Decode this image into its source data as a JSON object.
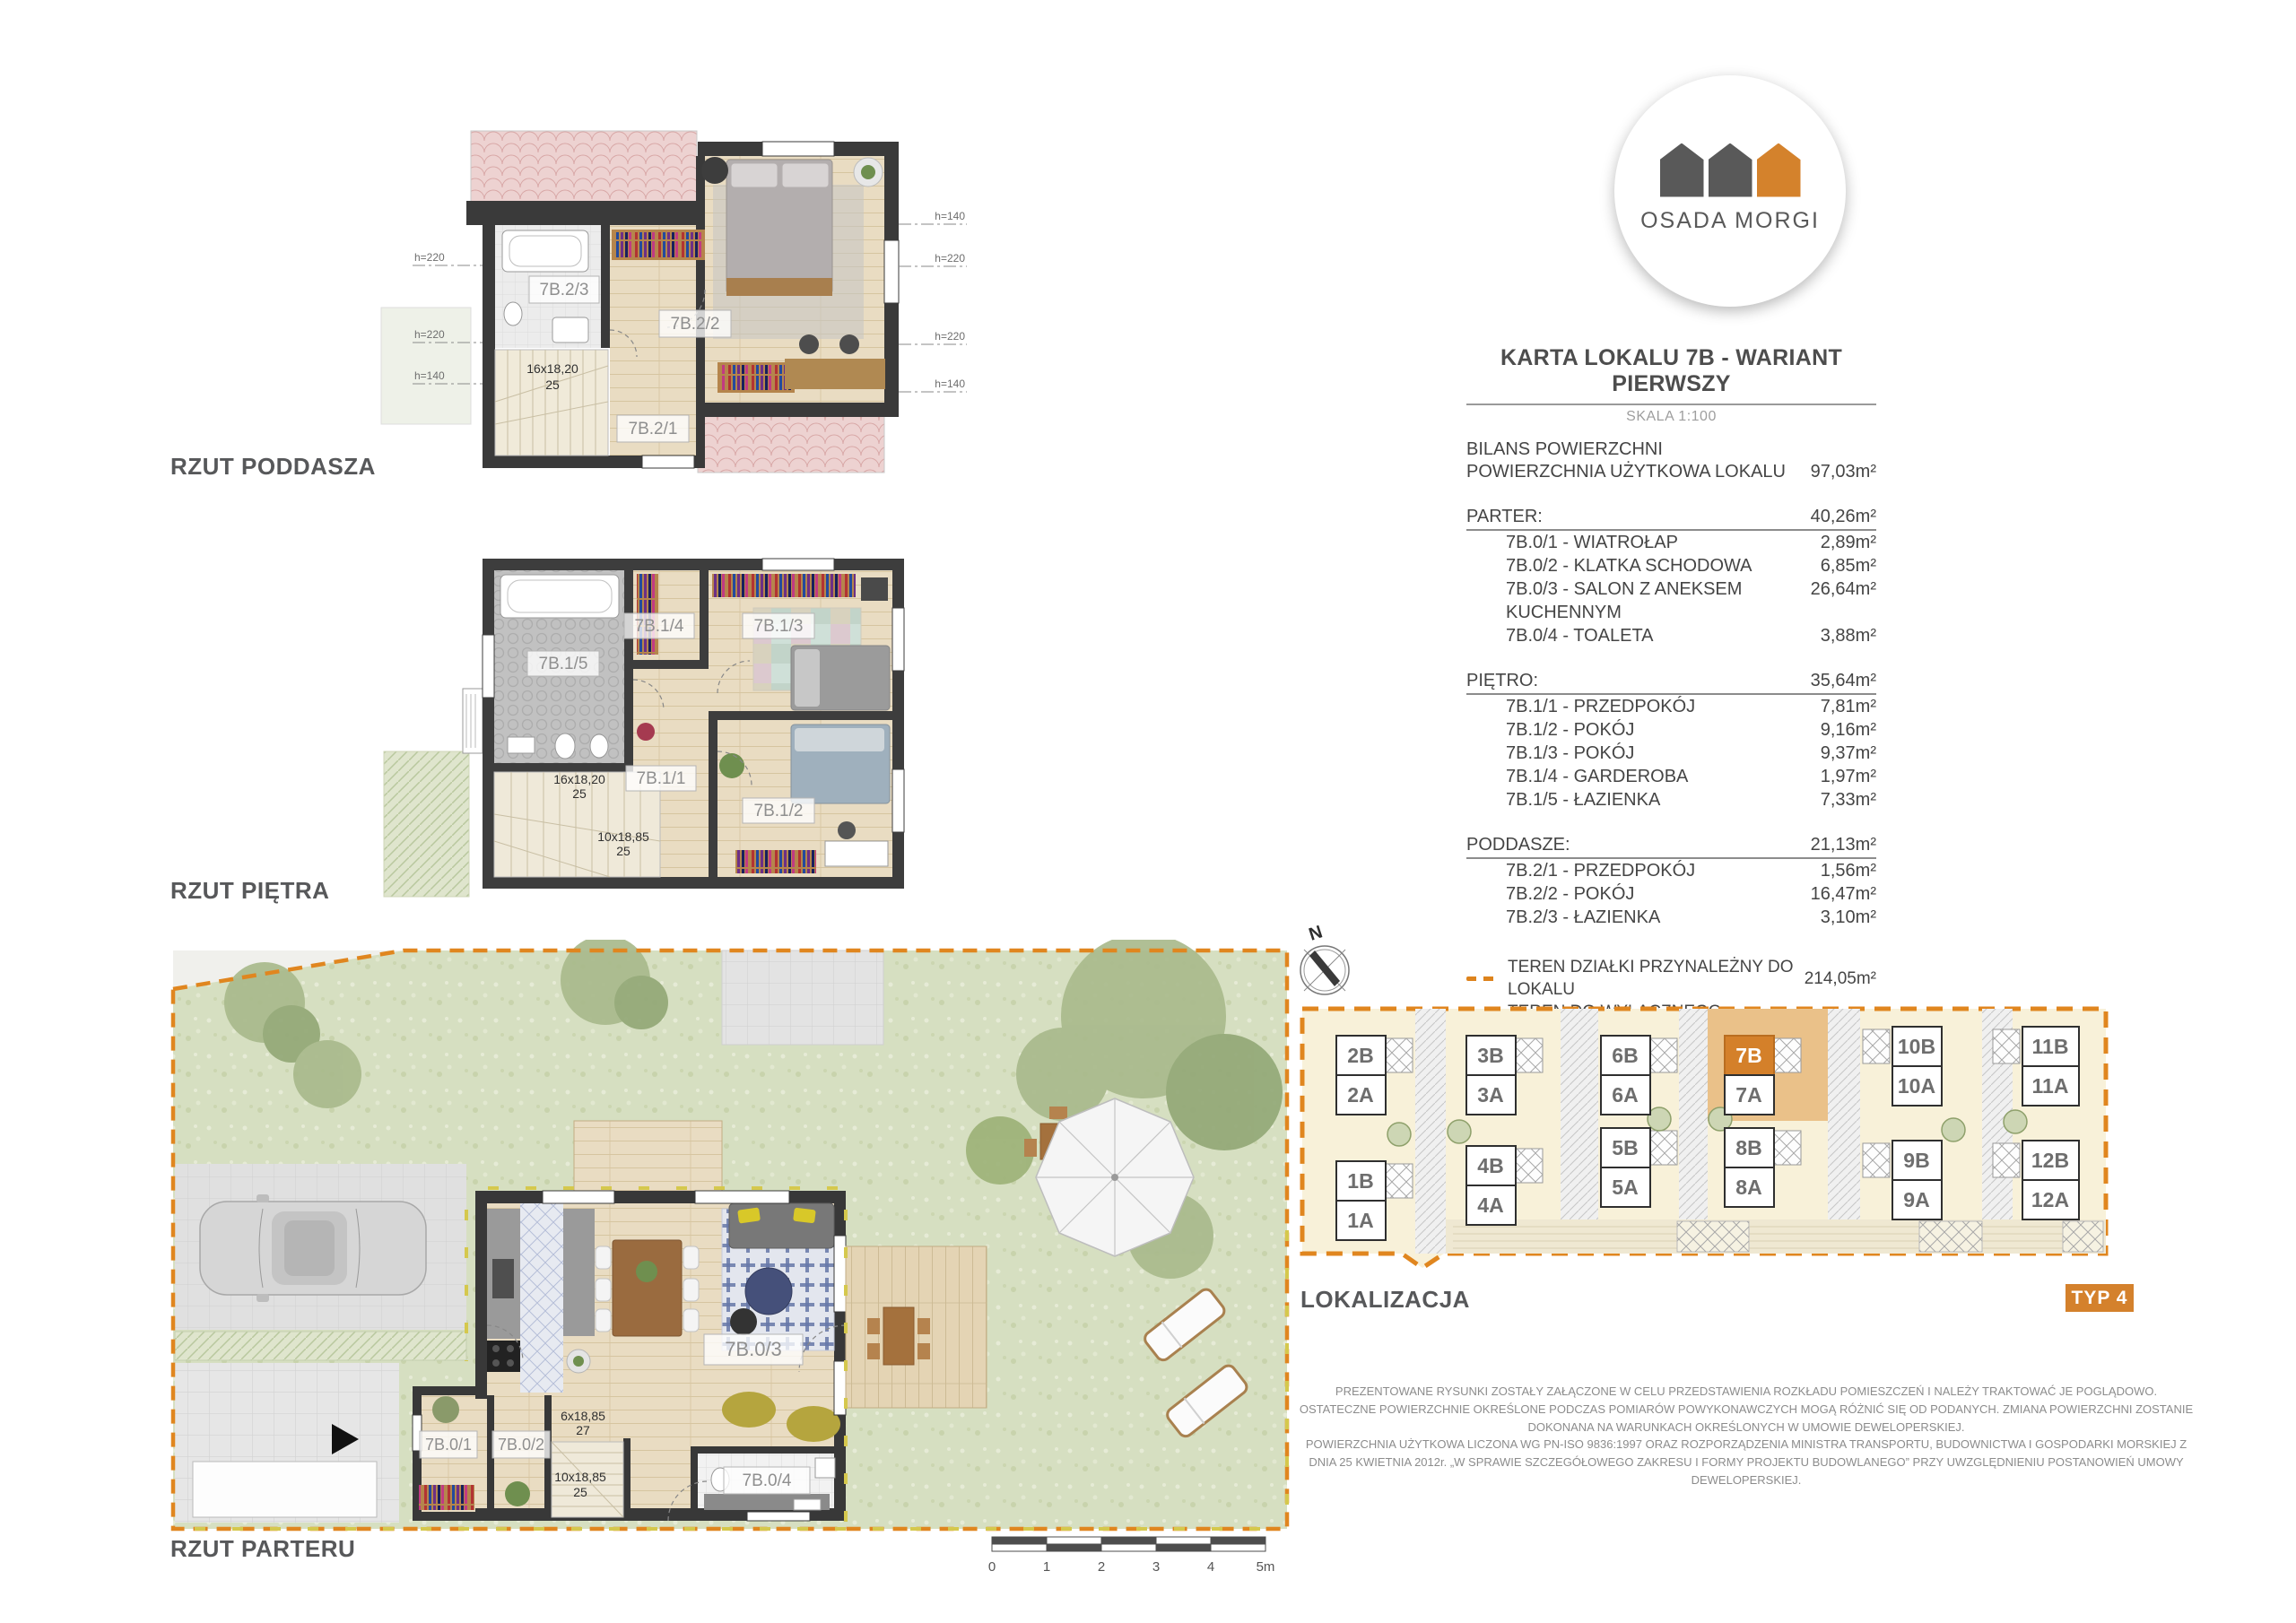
{
  "brand": {
    "name": "OSADA MORGI"
  },
  "header": {
    "title": "KARTA LOKALU 7B - WARIANT PIERWSZY",
    "scale": "SKALA 1:100",
    "bilans_label": "BILANS POWIERZCHNI",
    "usable_label": "POWIERZCHNIA UŻYTKOWA LOKALU",
    "usable_value": "97,03m²"
  },
  "sections": [
    {
      "label": "PARTER:",
      "total": "40,26m²",
      "rows": [
        {
          "name": "7B.0/1 - WIATROŁAP",
          "area": "2,89m²"
        },
        {
          "name": "7B.0/2 - KLATKA SCHODOWA",
          "area": "6,85m²"
        },
        {
          "name": "7B.0/3 - SALON Z ANEKSEM KUCHENNYM",
          "area": "26,64m²"
        },
        {
          "name": "7B.0/4 - TOALETA",
          "area": "3,88m²"
        }
      ]
    },
    {
      "label": "PIĘTRO:",
      "total": "35,64m²",
      "rows": [
        {
          "name": "7B.1/1 - PRZEDPOKÓJ",
          "area": "7,81m²"
        },
        {
          "name": "7B.1/2 - POKÓJ",
          "area": "9,16m²"
        },
        {
          "name": "7B.1/3 - POKÓJ",
          "area": "9,37m²"
        },
        {
          "name": "7B.1/4 - GARDEROBA",
          "area": "1,97m²"
        },
        {
          "name": "7B.1/5 - ŁAZIENKA",
          "area": "7,33m²"
        }
      ]
    },
    {
      "label": "PODDASZE:",
      "total": "21,13m²",
      "rows": [
        {
          "name": "7B.2/1 - PRZEDPOKÓJ",
          "area": "1,56m²"
        },
        {
          "name": "7B.2/2 - POKÓJ",
          "area": "16,47m²"
        },
        {
          "name": "7B.2/3 - ŁAZIENKA",
          "area": "3,10m²"
        }
      ]
    }
  ],
  "legend": [
    {
      "label": "TEREN DZIAŁKI PRZYNALEŻNY DO LOKALU",
      "area": "214,05m²"
    },
    {
      "label": "TEREN DO WYŁĄCZNEGO KORZYSTANIA",
      "area": "163,28m²"
    }
  ],
  "plans": {
    "poddasze": {
      "label": "RZUT PODDASZA",
      "rooms": {
        "r1": "7B.2/1",
        "r2": "7B.2/2",
        "r3": "7B.2/3"
      },
      "stair": {
        "dim": "16x18,20",
        "count": "25"
      },
      "heights_left": [
        "h=220",
        "h=220",
        "h=140"
      ],
      "heights_right": [
        "h=140",
        "h=220",
        "h=220",
        "h=140"
      ]
    },
    "pietro": {
      "label": "RZUT PIĘTRA",
      "rooms": {
        "r1": "7B.1/1",
        "r2": "7B.1/2",
        "r3": "7B.1/3",
        "r4": "7B.1/4",
        "r5": "7B.1/5"
      },
      "stair1": {
        "dim": "16x18,20",
        "count": "25"
      },
      "stair2": {
        "dim": "10x18,85",
        "count": "25"
      }
    },
    "parter": {
      "label": "RZUT PARTERU",
      "rooms": {
        "r1": "7B.0/1",
        "r2": "7B.0/2",
        "r3": "7B.0/3",
        "r4": "7B.0/4"
      },
      "stair1": {
        "dim": "6x18,85",
        "count": "27"
      },
      "stair2": {
        "dim": "10x18,85",
        "count": "25"
      }
    }
  },
  "location": {
    "label": "LOKALIZACJA",
    "compass": "N",
    "type_badge": "TYP 4",
    "highlighted_unit": "7B",
    "units": [
      "2B",
      "2A",
      "1B",
      "1A",
      "3B",
      "3A",
      "4B",
      "4A",
      "6B",
      "6A",
      "5B",
      "5A",
      "7B",
      "7A",
      "8B",
      "8A",
      "10B",
      "10A",
      "9B",
      "9A",
      "11B",
      "11A",
      "12B",
      "12A"
    ]
  },
  "scalebar": {
    "labels": [
      "0",
      "1",
      "2",
      "3",
      "4",
      "5m"
    ]
  },
  "disclaimer": {
    "p1": "PREZENTOWANE RYSUNKI ZOSTAŁY ZAŁĄCZONE W CELU PRZEDSTAWIENIA ROZKŁADU POMIESZCZEŃ I NALEŻY TRAKTOWAĆ JE POGLĄDOWO. OSTATECZNE POWIERZCHNIE OKREŚLONE PODCZAS POMIARÓW POWYKONAWCZYCH MOGĄ RÓŻNIĆ SIĘ OD PODANYCH. ZMIANA POWIERZCHNI ZOSTANIE DOKONANA NA WARUNKACH OKREŚLONYCH W UMOWIE DEWELOPERSKIEJ.",
    "p2": "POWIERZCHNIA UŻYTKOWA LICZONA WG PN-ISO 9836:1997 ORAZ ROZPORZĄDZENIA MINISTRA TRANSPORTU, BUDOWNICTWA I GOSPODARKI MORSKIEJ Z DNIA 25 KWIETNIA 2012r.   „W SPRAWIE SZCZEGÓŁOWEGO ZAKRESU I FORMY PROJEKTU BUDOWLANEGO” PRZY UWZGLĘDNIENIU POSTANOWIEŃ UMOWY DEWELOPERSKIEJ."
  },
  "colors": {
    "accent_orange": "#d4812c",
    "legend_orange": "#dd831d",
    "legend_yellow": "#d3c74b",
    "text_dark": "#4d4d4d",
    "text_gray": "#8c8c8c"
  }
}
